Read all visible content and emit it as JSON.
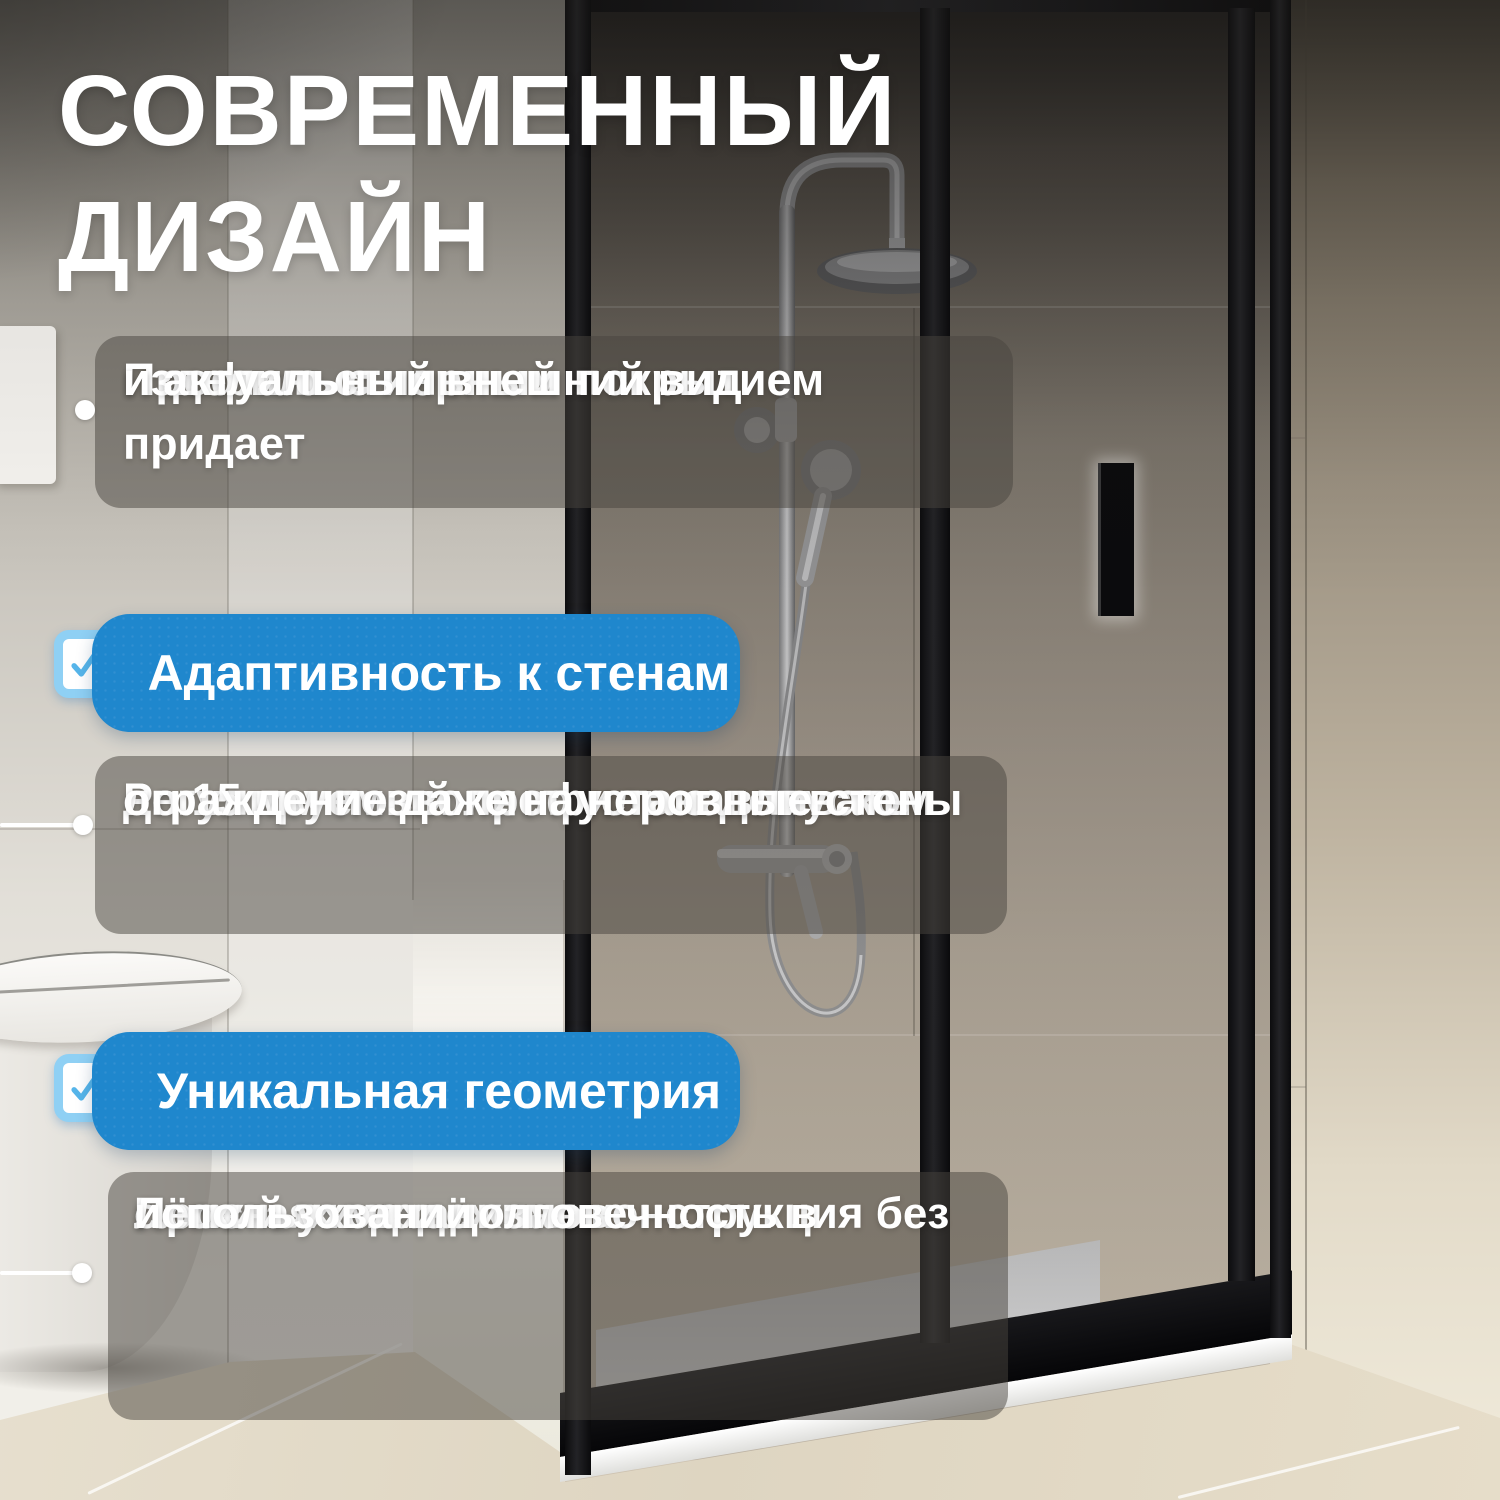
{
  "title": {
    "line1": "СОВРЕМЕННЫЙ",
    "line2": "ДИЗАЙН"
  },
  "feature_blocks": [
    {
      "lines": [
        "Профиль с черным покрытием придает",
        "изделию стильный",
        "и актуальный внешний вид"
      ]
    },
    {
      "lines": [
        "Регулируемый профиль с допуском",
        "до 15 мм позволяет устанавливать",
        "ограждение даже на неровные стены"
      ]
    },
    {
      "lines": [
        "Простая и надёжная конструкция без",
        "сложных механизмов",
        "Лёгкий уход и долговечность в",
        "использовании"
      ]
    }
  ],
  "badges": [
    {
      "label": "Адаптивность к стенам"
    },
    {
      "label": "Уникальная геометрия"
    }
  ],
  "colors": {
    "badge_blue": "#1f87cd",
    "checkbox_border": "#8fd0f4",
    "checkmark": "#56b5ea",
    "text_white": "#ffffff",
    "frame_black": "#101013",
    "overlay_gray": "rgba(72,68,61,0.5)"
  }
}
